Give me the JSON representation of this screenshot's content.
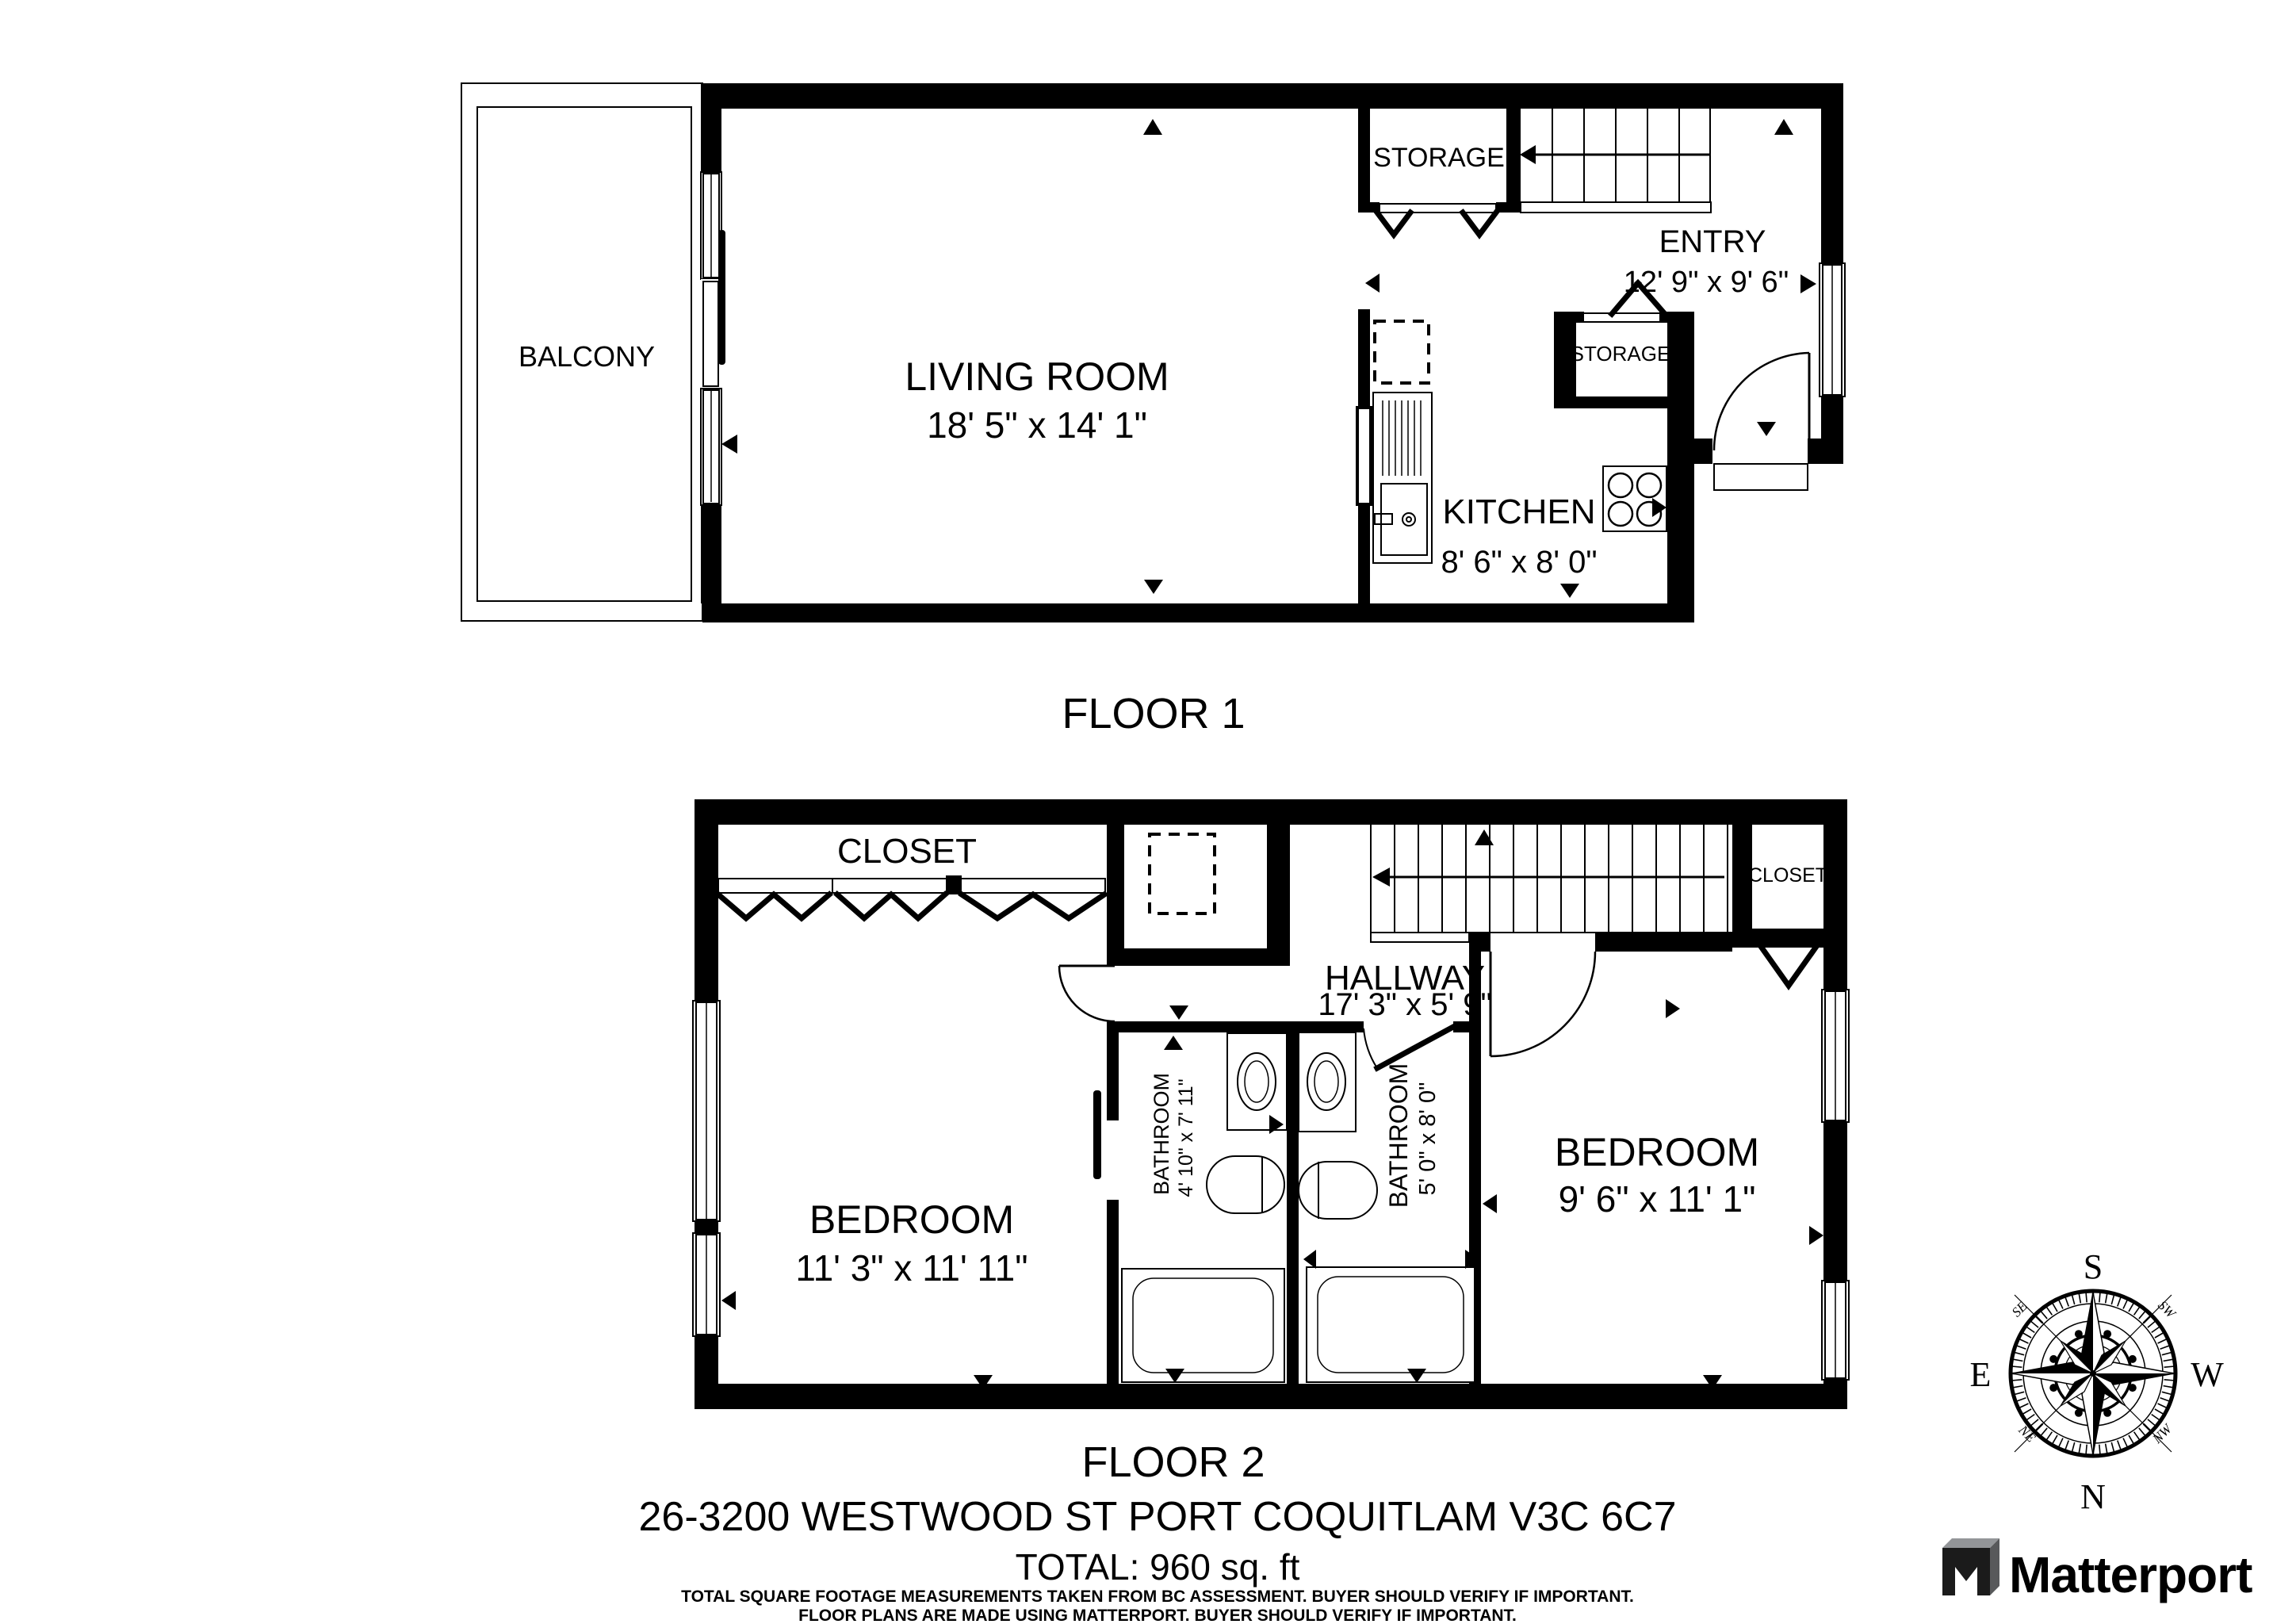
{
  "floor1": {
    "label": "FLOOR 1",
    "balcony": {
      "name": "BALCONY"
    },
    "living_room": {
      "name": "LIVING ROOM",
      "dims": "18' 5\" x 14' 1\""
    },
    "storage_upper": {
      "name": "STORAGE"
    },
    "entry": {
      "name": "ENTRY",
      "dims": "12' 9\" x 9' 6\""
    },
    "storage_closet": {
      "name": "STORAGE"
    },
    "kitchen": {
      "name": "KITCHEN",
      "dims": "8' 6\" x 8' 0\""
    }
  },
  "floor2": {
    "label": "FLOOR 2",
    "closet_left": {
      "name": "CLOSET"
    },
    "closet_right": {
      "name": "CLOSET"
    },
    "hallway": {
      "name": "HALLWAY",
      "dims": "17' 3\" x 5' 9\""
    },
    "bedroom_left": {
      "name": "BEDROOM",
      "dims": "11' 3\" x 11' 11\""
    },
    "bathroom_left": {
      "name": "BATHROOM",
      "dims": "4' 10\" x 7' 11\""
    },
    "bathroom_right": {
      "name": "BATHROOM",
      "dims": "5' 0\" x 8' 0\""
    },
    "bedroom_right": {
      "name": "BEDROOM",
      "dims": "9' 6\" x 11' 1\""
    }
  },
  "compass": {
    "n": "N",
    "s": "S",
    "e": "E",
    "w": "W",
    "se": "SE",
    "sw": "SW",
    "ne": "NE",
    "nw": "NW"
  },
  "footer": {
    "address": "26-3200 WESTWOOD ST PORT COQUITLAM V3C 6C7",
    "total": "TOTAL: 960 sq. ft",
    "disclaimer1": "TOTAL SQUARE FOOTAGE MEASUREMENTS TAKEN FROM BC ASSESSMENT. BUYER SHOULD VERIFY IF IMPORTANT.",
    "disclaimer2": "FLOOR PLANS ARE MADE USING MATTERPORT. BUYER SHOULD VERIFY IF IMPORTANT."
  },
  "logo": {
    "brand": "Matterport"
  },
  "colors": {
    "ink": "#000000",
    "logo_text": "#3e4246",
    "logo_gray": "#939598"
  }
}
